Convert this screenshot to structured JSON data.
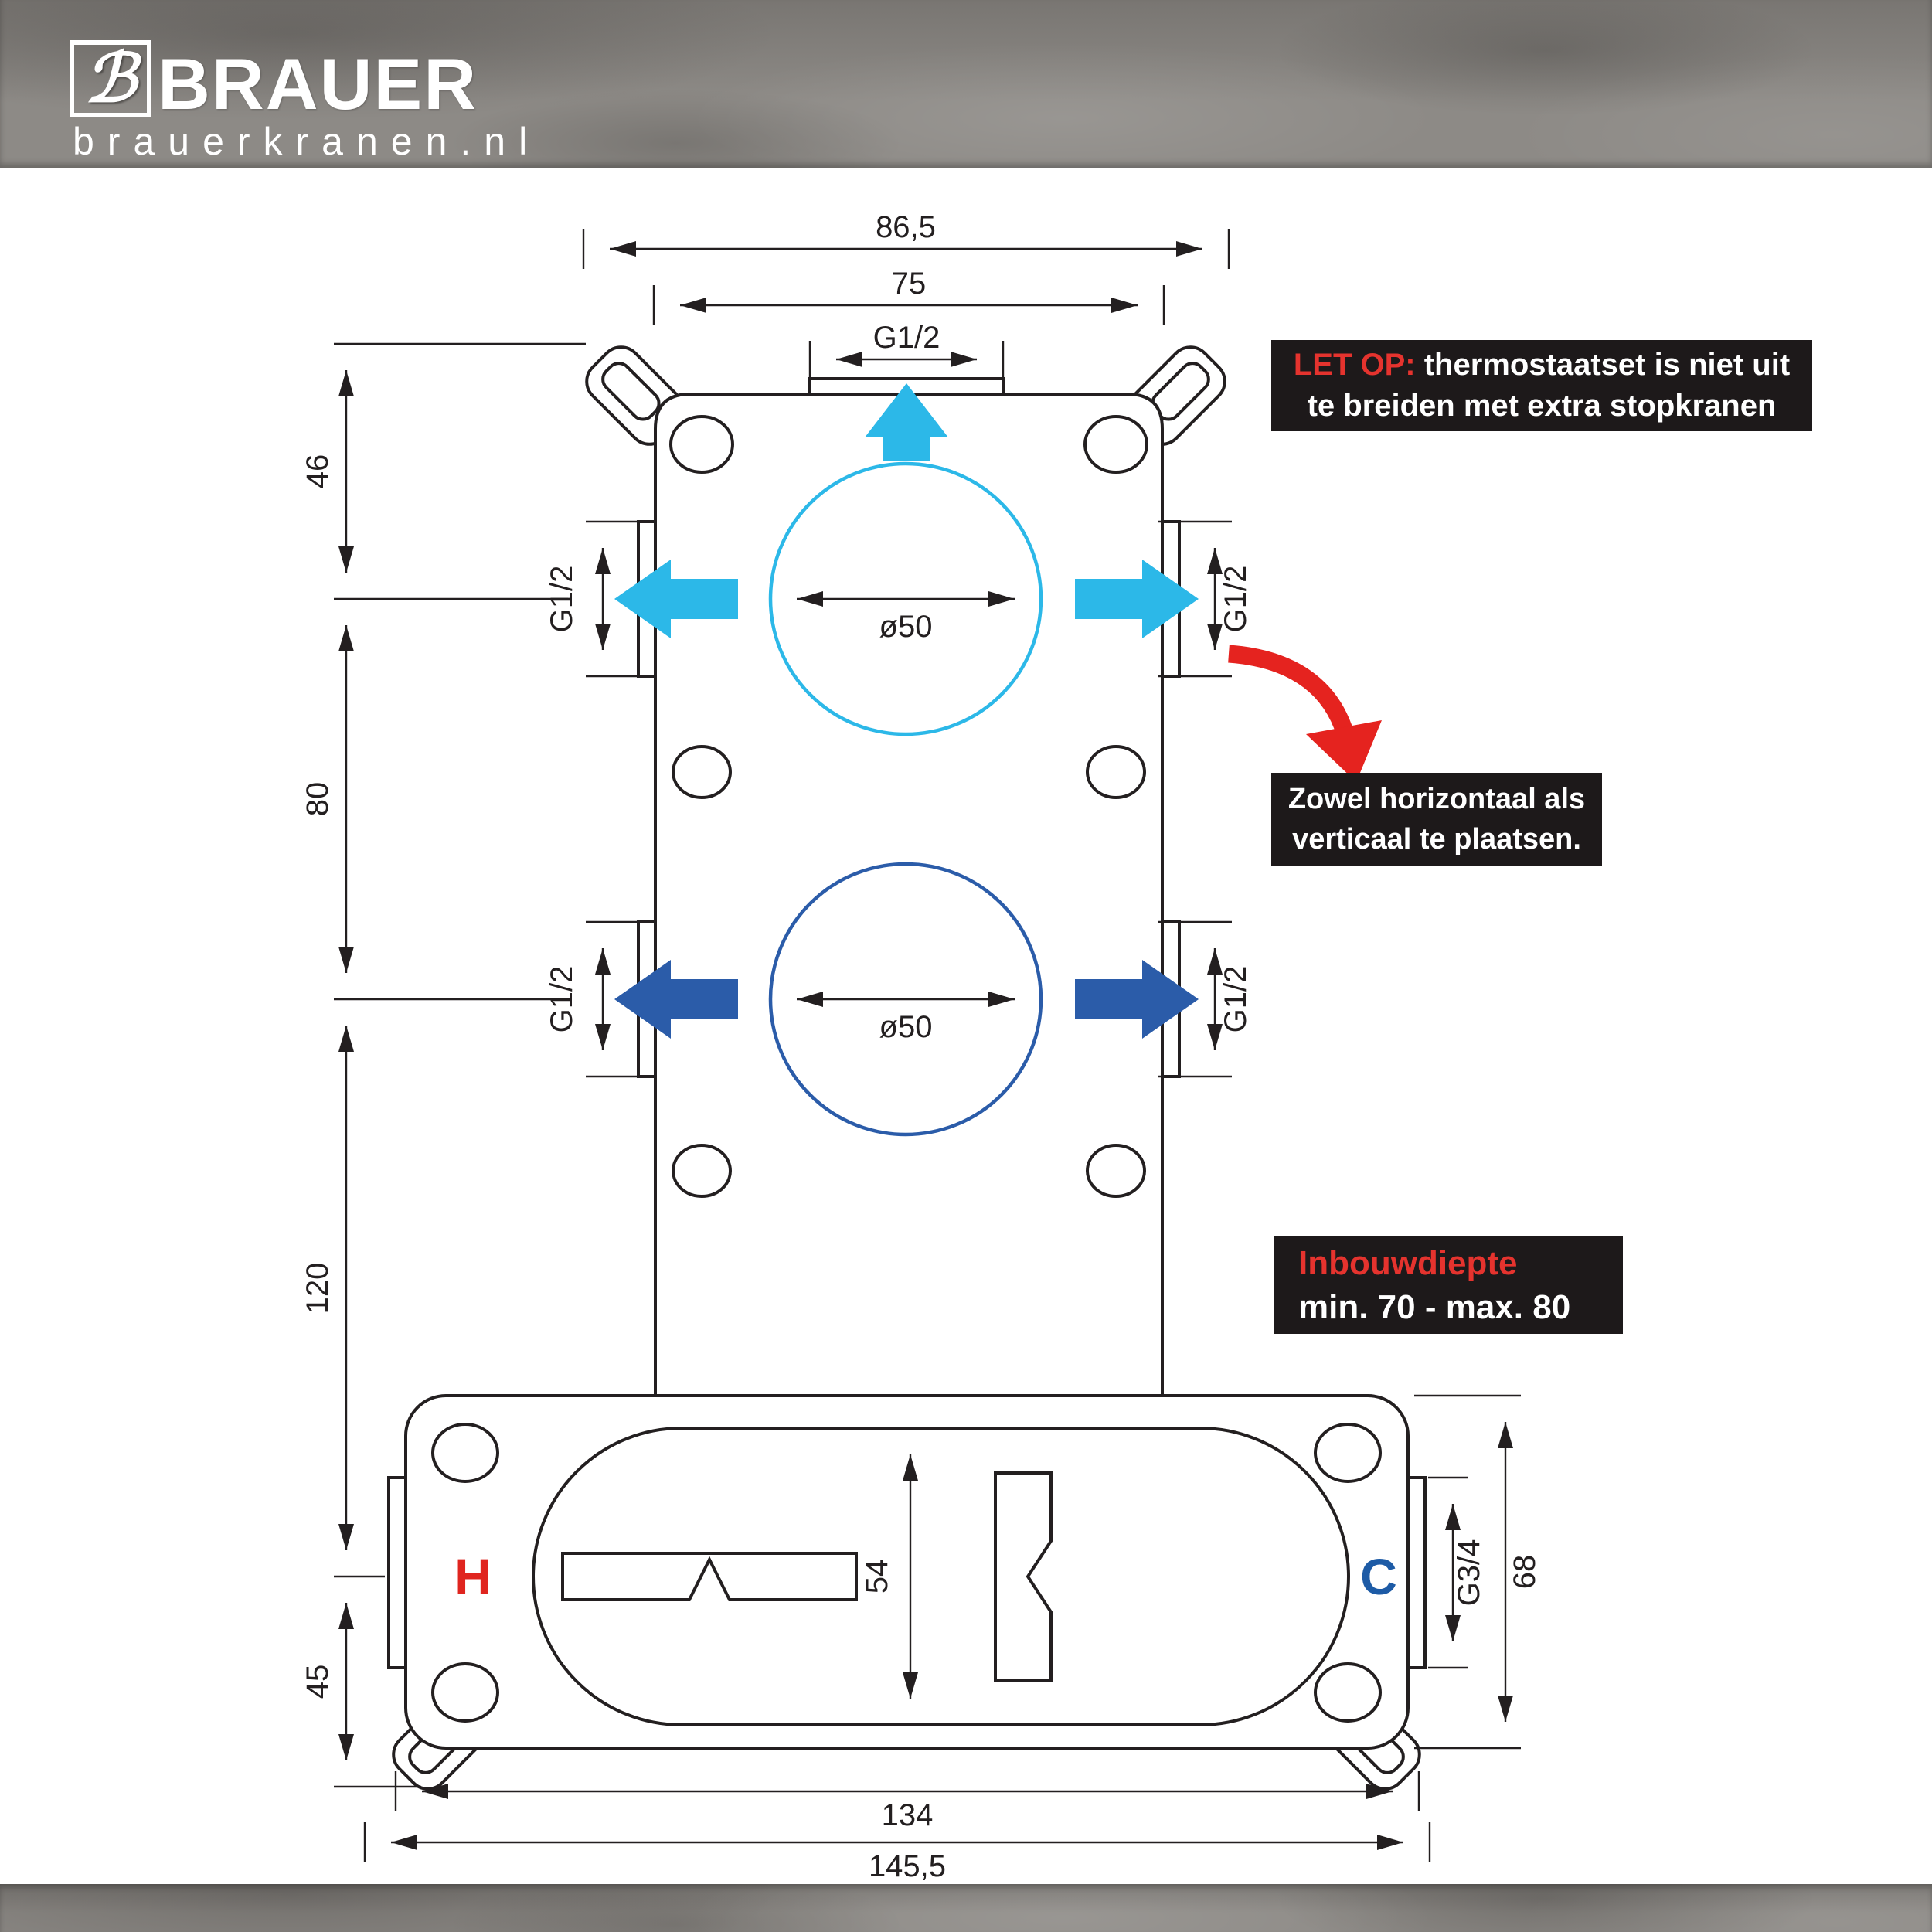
{
  "header": {
    "logo_mark": "ℬ",
    "brand": "BRAUER",
    "website": "brauerkranen.nl"
  },
  "callouts": {
    "warning": {
      "prefix": "LET OP:",
      "line1": "thermostaatset is niet uit",
      "line2": "te breiden met extra stopkranen"
    },
    "placement": {
      "line1": "Zowel horizontaal als",
      "line2": "verticaal te plaatsen."
    },
    "depth": {
      "title": "Inbouwdiepte",
      "range": "min. 70 - max. 80"
    }
  },
  "labels": {
    "hot": "H",
    "cold": "C"
  },
  "dimensions": {
    "top_outer_width": "86,5",
    "top_inner_width": "75",
    "top_outlet": "G1/2",
    "offset_top": "46",
    "spacing_circles": "80",
    "spacing_lower": "120",
    "offset_bottom": "45",
    "upper_circle_diameter": "ø50",
    "lower_circle_diameter": "ø50",
    "upper_left_port": "G1/2",
    "upper_right_port": "G1/2",
    "lower_left_port": "G1/2",
    "lower_right_port": "G1/2",
    "valve_body_height": "54",
    "cold_inlet": "G3/4",
    "housing_height": "68",
    "bottom_inner_width": "134",
    "bottom_outer_width": "145,5"
  },
  "colors": {
    "hot_red": "#e0251f",
    "cold_blue": "#1d5ba6",
    "flow_cyan": "#2cb8e8",
    "flow_blue": "#2b5ca9",
    "callout_bg": "#1d191a",
    "line": "#231f20"
  }
}
